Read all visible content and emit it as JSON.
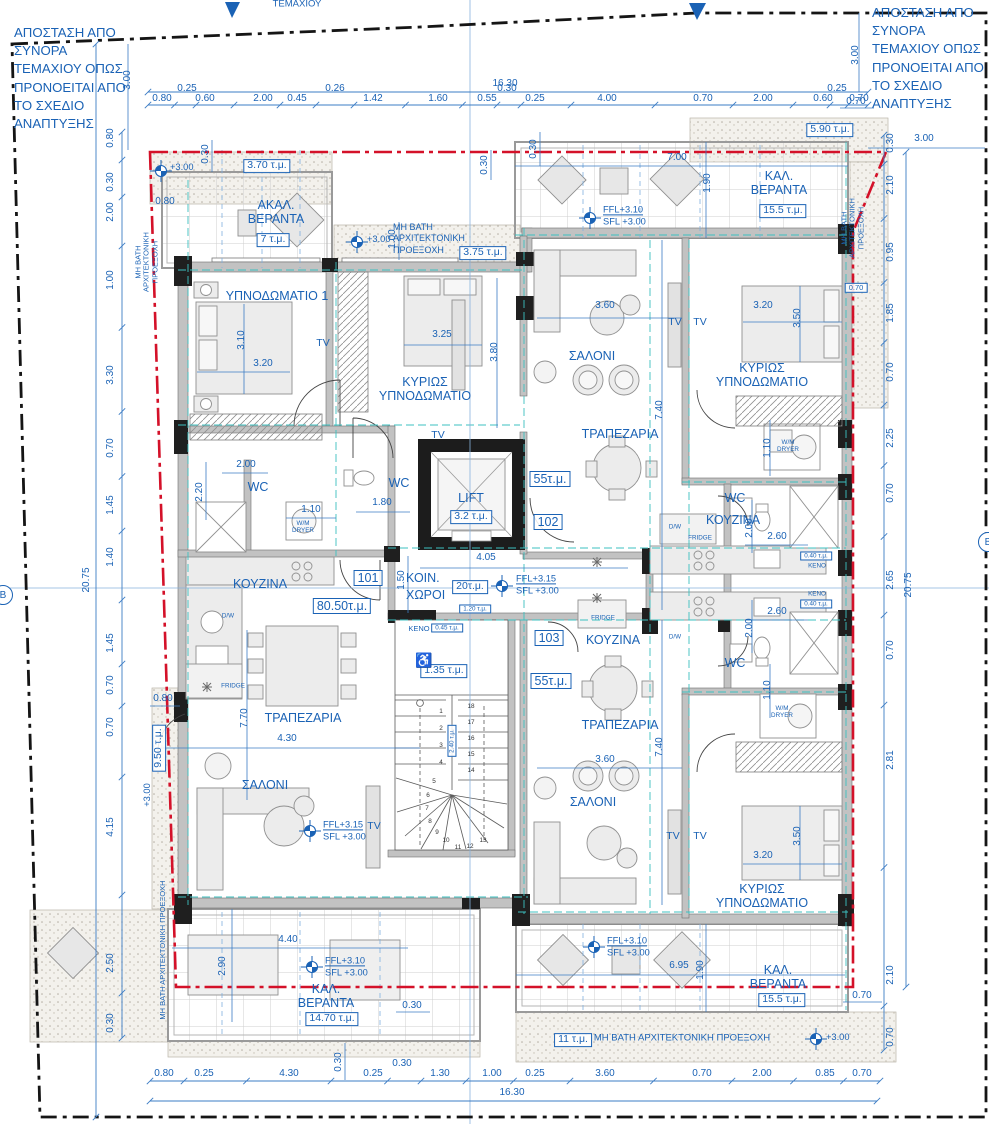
{
  "notes": {
    "boundary": "ΑΠΟΣΤΑΣΗ ΑΠΟ ΣΥΝΟΡΑ ΤΕΜΑΧΙΟΥ ΟΠΩΣ ΠΡΟΝΟΕΙΤΑΙ ΑΠΟ ΤΟ ΣΧΕΔΙΟ ΑΝΑΠΤΥΞΗΣ",
    "projection": "ΜΗ ΒΑΤΗ ΑΡΧΙΤΕΚΤΟΝΙΚΗ ΠΡΟΕΞΟΧΗ",
    "plot_edge": "ΤΕΜΑΧΙΟΥ",
    "section_marker": "Β"
  },
  "icons": {
    "wheelchair": "♿"
  },
  "rooms": {
    "bedroom1": "ΥΠΝΟΔΩΜΑΤΙΟ 1",
    "master": "ΚΥΡΙΩΣ ΥΠΝΟΔΩΜΑΤΙΟ",
    "salon": "ΣΑΛΟΝΙ",
    "dining": "ΤΡΑΠΕΖΑΡΙΑ",
    "kitchen": "ΚΟΥΖΙΝΑ",
    "wc": "WC",
    "lift": "LIFT",
    "common": "ΚΟΙΝ. ΧΩΡΟΙ",
    "tv": "TV",
    "fridge": "FRIDGE",
    "dw": "D/W",
    "wm": "W/M DRYER",
    "keno": "ΚΕΝΟ"
  },
  "units": {
    "a101": "101",
    "a102": "102",
    "a103": "103"
  },
  "areas": {
    "lift": "3.2 τ.μ.",
    "common": "20τ.μ.",
    "a101": "80.50τ.μ.",
    "a102": "55τ.μ.",
    "a103": "55τ.μ.",
    "akal": "7 τ.μ.",
    "akal_roof": "3.70 τ.μ.",
    "proj_top": "3.75 τ.μ.",
    "proj_tr": "5.90 τ.μ.",
    "ver_tr": "15.5 τ.μ.",
    "ver_bl": "14.70 τ.μ.",
    "ver_br": "15.5 τ.μ.",
    "proj_left": "9.50 τ.μ.",
    "proj_bottom": "11 τ.μ.",
    "keno_small": "0.40 τ.μ.",
    "keno_mid": "0.45 τ.μ.",
    "lobby": "1.20 τ.μ.",
    "acc_wc": "1.35 τ.μ.",
    "stair_void": "2.40 τ.μ.",
    "offset_070": "0.70"
  },
  "verandas": {
    "akal": "ΑΚΑΛ. ΒΕΡΑΝΤΑ",
    "kal": "ΚΑΛ. ΒΕΡΑΝΤΑ"
  },
  "levels": {
    "plus300": "+3.00",
    "ffl310": "FFL+3.10",
    "ffl315": "FFL+3.15",
    "sfl300": "SFL +3.00"
  },
  "dims": {
    "top": [
      "0.80",
      "0.25",
      "0.60",
      "2.00",
      "0.45",
      "0.26",
      "1.42",
      "1.60",
      "0.55",
      "0.30",
      "0.25",
      "4.00",
      "0.70",
      "2.00",
      "0.60",
      "0.25",
      "0.70"
    ],
    "top_overall": [
      "16.30"
    ],
    "bottom": [
      "0.80",
      "0.25",
      "4.30",
      "0.25",
      "0.30",
      "1.30",
      "1.00",
      "0.25",
      "3.60",
      "0.70",
      "2.00",
      "0.85",
      "0.70"
    ],
    "bottom_overall": [
      "16.30"
    ],
    "left": [
      "0.80",
      "0.30",
      "2.00",
      "1.00",
      "3.30",
      "0.70",
      "1.45",
      "1.40",
      "1.45",
      "0.70",
      "0.70",
      "4.15",
      "2.50",
      "0.30"
    ],
    "left_overall": [
      "20.75"
    ],
    "right": [
      "0.30",
      "2.10",
      "0.95",
      "1.85",
      "0.70",
      "2.25",
      "0.70",
      "2.65",
      "0.70",
      "2.81",
      "2.10",
      "0.70"
    ],
    "right_overall": [
      "20.75"
    ],
    "inner": [
      "3.10",
      "3.20",
      "3.25",
      "3.80",
      "2.00",
      "2.20",
      "1.10",
      "1.80",
      "4.05",
      "1.50",
      "7.70",
      "4.30",
      "0.80",
      "3.60",
      "7.40",
      "3.20",
      "3.50",
      "1.10",
      "2.00",
      "2.60",
      "2.60",
      "2.00",
      "1.10",
      "3.60",
      "7.40",
      "3.20",
      "3.50",
      "7.00",
      "1.90",
      "0.30",
      "4.40",
      "2.90",
      "0.30",
      "6.95",
      "1.90",
      "0.70",
      "0.30",
      "0.80",
      "0.30",
      "1.00",
      "0.30",
      "3.00",
      "3.00",
      "3.00",
      "0.70"
    ]
  },
  "stairs": {
    "treads": [
      "1",
      "2",
      "3",
      "4",
      "5",
      "6",
      "7",
      "8",
      "9",
      "10",
      "11",
      "12",
      "13",
      "14",
      "15",
      "16",
      "17",
      "18"
    ]
  }
}
